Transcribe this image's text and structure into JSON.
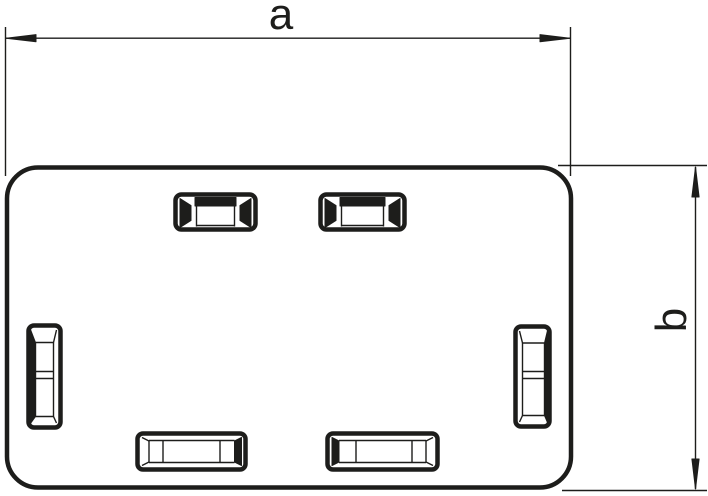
{
  "page": {
    "background_color": "#ffffff",
    "line_color": "#1d1d1b"
  },
  "drawing": {
    "type": "technical-dimension-drawing",
    "subject": "rounded rectangular cover plate with six latch slots",
    "slot_count": 6,
    "dimension_labels": {
      "width": "a",
      "height": "b"
    },
    "markers": {
      "width_dimension": "filled-arrowheads-left-right",
      "height_dimension": "filled-arrowheads-up-down"
    }
  }
}
